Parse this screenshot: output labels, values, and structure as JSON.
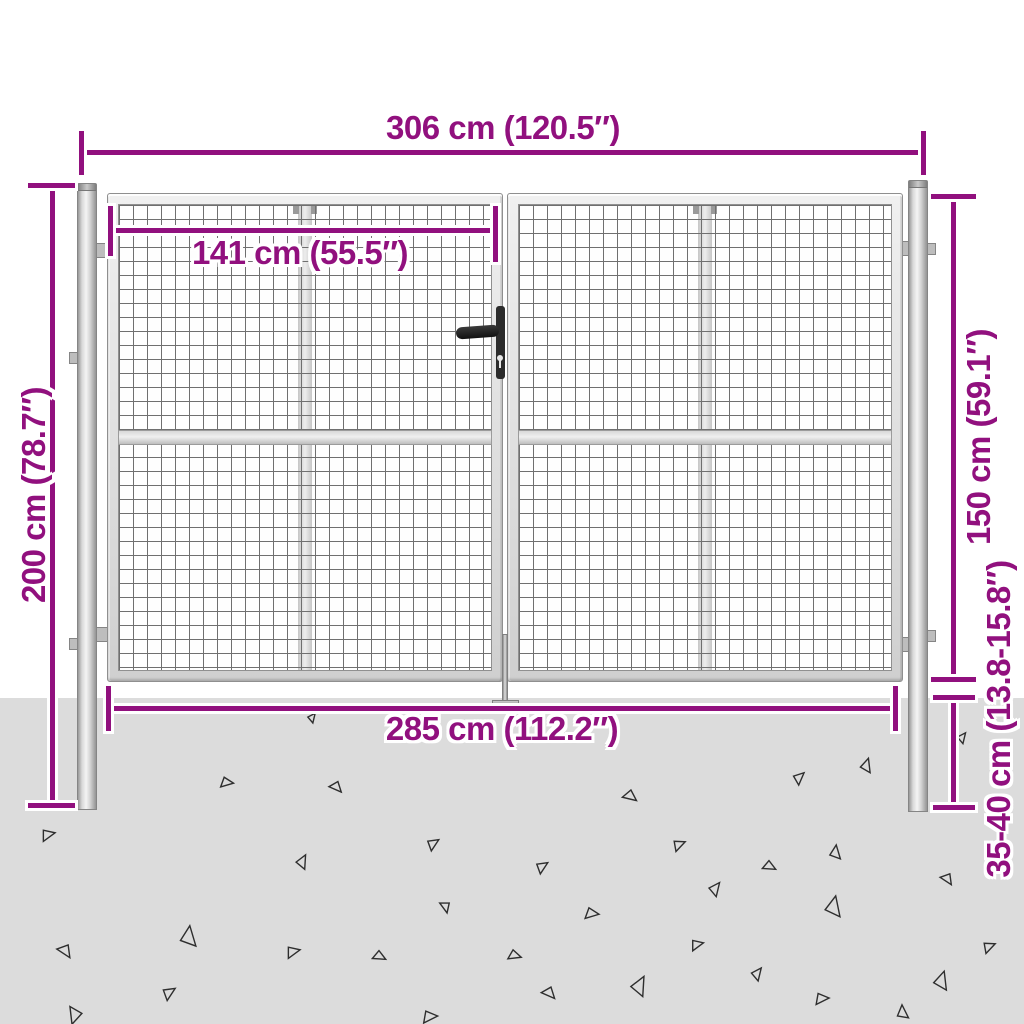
{
  "diagram": {
    "accent_color": "#91107E",
    "ground_color": "#DCDCDC"
  },
  "dimensions": {
    "total_width": "306 cm (120.5″)",
    "leaf_inner_width": "141 cm (55.5″)",
    "post_height": "200 cm (78.7″)",
    "gate_height": "150 cm (59.1″)",
    "inner_width": "285 cm (112.2″)",
    "ground_depth": "35-40 cm (13.8-15.8″)"
  },
  "ground": {
    "triangles": [
      {
        "x": 312,
        "y": 717,
        "s": 9,
        "r": 40
      },
      {
        "x": 227,
        "y": 782,
        "s": 12,
        "r": 100
      },
      {
        "x": 337,
        "y": 787,
        "s": 12,
        "r": 140
      },
      {
        "x": 48,
        "y": 834,
        "s": 13,
        "r": 80
      },
      {
        "x": 433,
        "y": 843,
        "s": 12,
        "r": 60
      },
      {
        "x": 302,
        "y": 861,
        "s": 13,
        "r": 30
      },
      {
        "x": 446,
        "y": 907,
        "s": 11,
        "r": 170
      },
      {
        "x": 188,
        "y": 936,
        "s": 19,
        "r": 10
      },
      {
        "x": 66,
        "y": 951,
        "s": 14,
        "r": 150
      },
      {
        "x": 293,
        "y": 951,
        "s": 13,
        "r": 80
      },
      {
        "x": 380,
        "y": 956,
        "s": 12,
        "r": 120
      },
      {
        "x": 169,
        "y": 992,
        "s": 13,
        "r": 60
      },
      {
        "x": 75,
        "y": 1016,
        "s": 16,
        "r": 200
      },
      {
        "x": 430,
        "y": 1016,
        "s": 14,
        "r": 90
      },
      {
        "x": 866,
        "y": 765,
        "s": 13,
        "r": 20
      },
      {
        "x": 962,
        "y": 737,
        "s": 10,
        "r": 40
      },
      {
        "x": 799,
        "y": 777,
        "s": 12,
        "r": 50
      },
      {
        "x": 631,
        "y": 796,
        "s": 13,
        "r": 130
      },
      {
        "x": 679,
        "y": 844,
        "s": 12,
        "r": 70
      },
      {
        "x": 835,
        "y": 852,
        "s": 13,
        "r": 10
      },
      {
        "x": 770,
        "y": 866,
        "s": 12,
        "r": 120
      },
      {
        "x": 948,
        "y": 879,
        "s": 12,
        "r": 150
      },
      {
        "x": 715,
        "y": 888,
        "s": 13,
        "r": 40
      },
      {
        "x": 833,
        "y": 906,
        "s": 19,
        "r": 15
      },
      {
        "x": 592,
        "y": 913,
        "s": 13,
        "r": 100
      },
      {
        "x": 542,
        "y": 866,
        "s": 12,
        "r": 60
      },
      {
        "x": 697,
        "y": 944,
        "s": 12,
        "r": 80
      },
      {
        "x": 757,
        "y": 973,
        "s": 12,
        "r": 40
      },
      {
        "x": 639,
        "y": 985,
        "s": 18,
        "r": 30
      },
      {
        "x": 822,
        "y": 998,
        "s": 13,
        "r": 90
      },
      {
        "x": 550,
        "y": 993,
        "s": 13,
        "r": 140
      },
      {
        "x": 941,
        "y": 980,
        "s": 17,
        "r": 20
      },
      {
        "x": 989,
        "y": 946,
        "s": 12,
        "r": 70
      },
      {
        "x": 902,
        "y": 1012,
        "s": 13,
        "r": 0
      },
      {
        "x": 515,
        "y": 955,
        "s": 12,
        "r": 110
      }
    ]
  }
}
